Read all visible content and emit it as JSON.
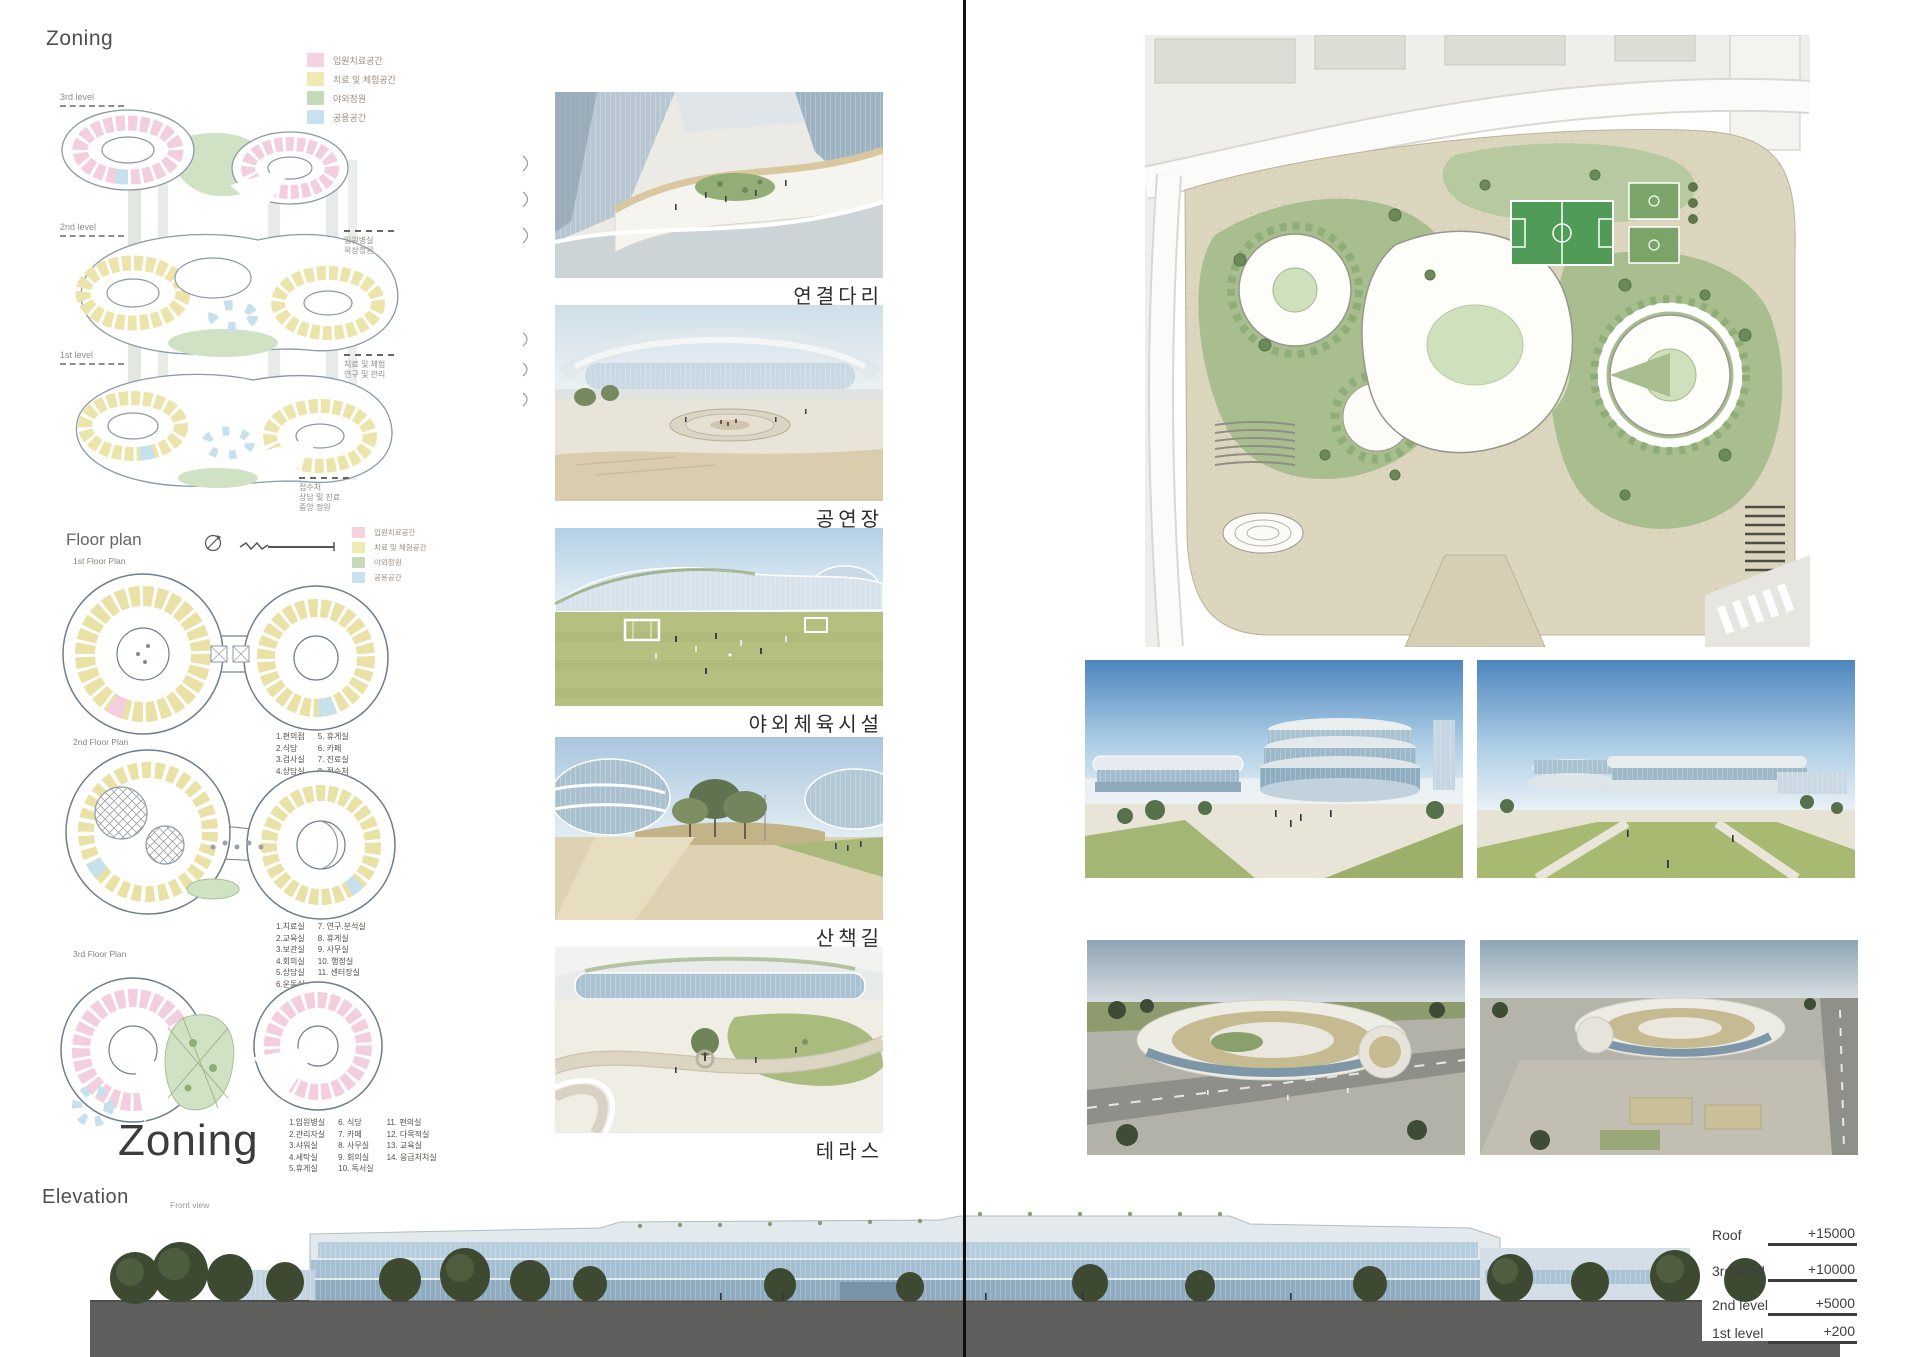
{
  "board": {
    "zoning_title": "Zoning",
    "floor_plan_title": "Floor plan",
    "zoning_large": "Zoning",
    "elevation_title": "Elevation",
    "front_view_label": "Front view"
  },
  "legend": {
    "items": [
      {
        "label": "입원치료공간",
        "color": "#f6d2e0"
      },
      {
        "label": "치료 및 체험공간",
        "color": "#efe9b3"
      },
      {
        "label": "야외정원",
        "color": "#c5dab8"
      },
      {
        "label": "공용공간",
        "color": "#c6e2ee"
      }
    ]
  },
  "zoning_axon": {
    "levels": [
      "3rd level",
      "2nd level",
      "1st level"
    ],
    "callouts": [
      {
        "line1": "입원병실",
        "line2": "옥상정원",
        "line3": ""
      },
      {
        "line1": "치료 및 체험",
        "line2": "연구 및 관리",
        "line3": ""
      },
      {
        "line1": "접수처",
        "line2": "상담 및 진료",
        "line3": "중앙 정원"
      }
    ]
  },
  "floor_plans": {
    "first": {
      "label": "1st Floor Plan",
      "col1": [
        "1.편의점",
        "2.식당",
        "3.검사실",
        "4.상담실"
      ],
      "col2": [
        "5. 휴게실",
        "6. 카페",
        "7. 진료실",
        "8. 접수처"
      ]
    },
    "second": {
      "label": "2nd Floor Plan",
      "col1": [
        "1.치료실",
        "2.교육실",
        "3.보관실",
        "4.회의실",
        "5.상담실",
        "6.운동실"
      ],
      "col2": [
        "7. 연구.분석실",
        "8. 휴게실",
        "9. 사무실",
        "10. 행정실",
        "11. 센터장실"
      ]
    },
    "third": {
      "label": "3rd Floor Plan",
      "col1": [
        "1.입원병실",
        "2.관리자실",
        "3.샤워실",
        "4.세탁실",
        "5.휴게실"
      ],
      "col2": [
        "6. 식당",
        "7. 카페",
        "8. 사무실",
        "9. 회의실",
        "10. 독서실"
      ],
      "col3": [
        "11. 편의실",
        "12. 다목적실",
        "13. 교육실",
        "14. 응급처치실"
      ]
    }
  },
  "renders": {
    "captions": [
      "연결다리",
      "공연장",
      "야외체육시설",
      "산책길",
      "테라스"
    ]
  },
  "elevation": {
    "levels": [
      {
        "name": "Roof",
        "value": "+15000"
      },
      {
        "name": "3rd level",
        "value": "+10000"
      },
      {
        "name": "2nd level",
        "value": "+5000"
      },
      {
        "name": "1st level",
        "value": "+200"
      }
    ]
  },
  "colors": {
    "inpatient_pink": "#f6d2e0",
    "treatment_yellow": "#efe9b3",
    "garden_green": "#c5dab8",
    "common_blue": "#c6e2ee",
    "elevation_glass": "#a4bfd2",
    "ground_gray": "#5f5f5d"
  }
}
